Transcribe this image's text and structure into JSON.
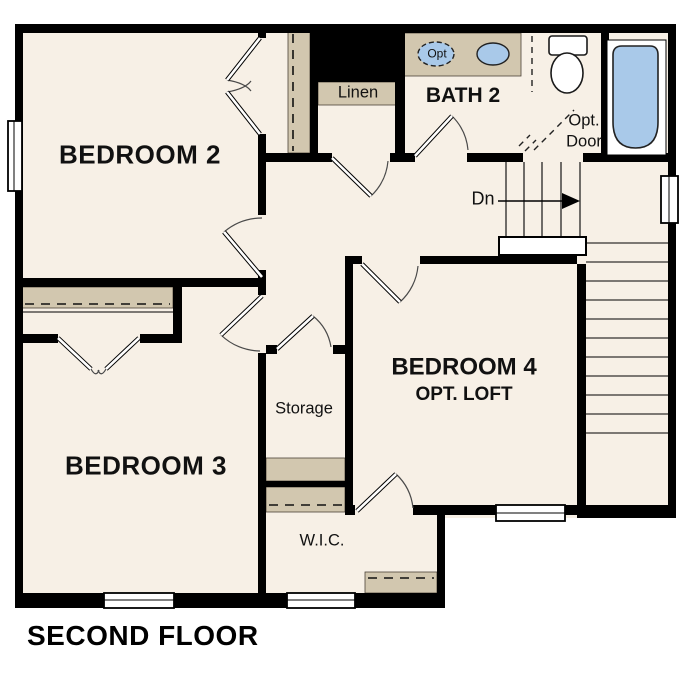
{
  "title": "SECOND FLOOR",
  "colors": {
    "floor": "#f7f0e6",
    "shelf": "#d2c7af",
    "fixture_blue": "#a9c9e9",
    "wall": "#000000",
    "background": "#ffffff"
  },
  "rooms": {
    "bedroom2": {
      "label": "BEDROOM 2"
    },
    "bath2": {
      "label": "BATH 2"
    },
    "linen": {
      "label": "Linen"
    },
    "bedroom3": {
      "label": "BEDROOM 3"
    },
    "storage": {
      "label": "Storage"
    },
    "wic": {
      "label": "W.I.C."
    },
    "bedroom4": {
      "label": "BEDROOM 4",
      "sublabel": "OPT. LOFT"
    }
  },
  "annotations": {
    "stairs_down": "Dn",
    "opt_door_line1": "Opt.",
    "opt_door_line2": "Door",
    "opt_sink": "Opt"
  }
}
